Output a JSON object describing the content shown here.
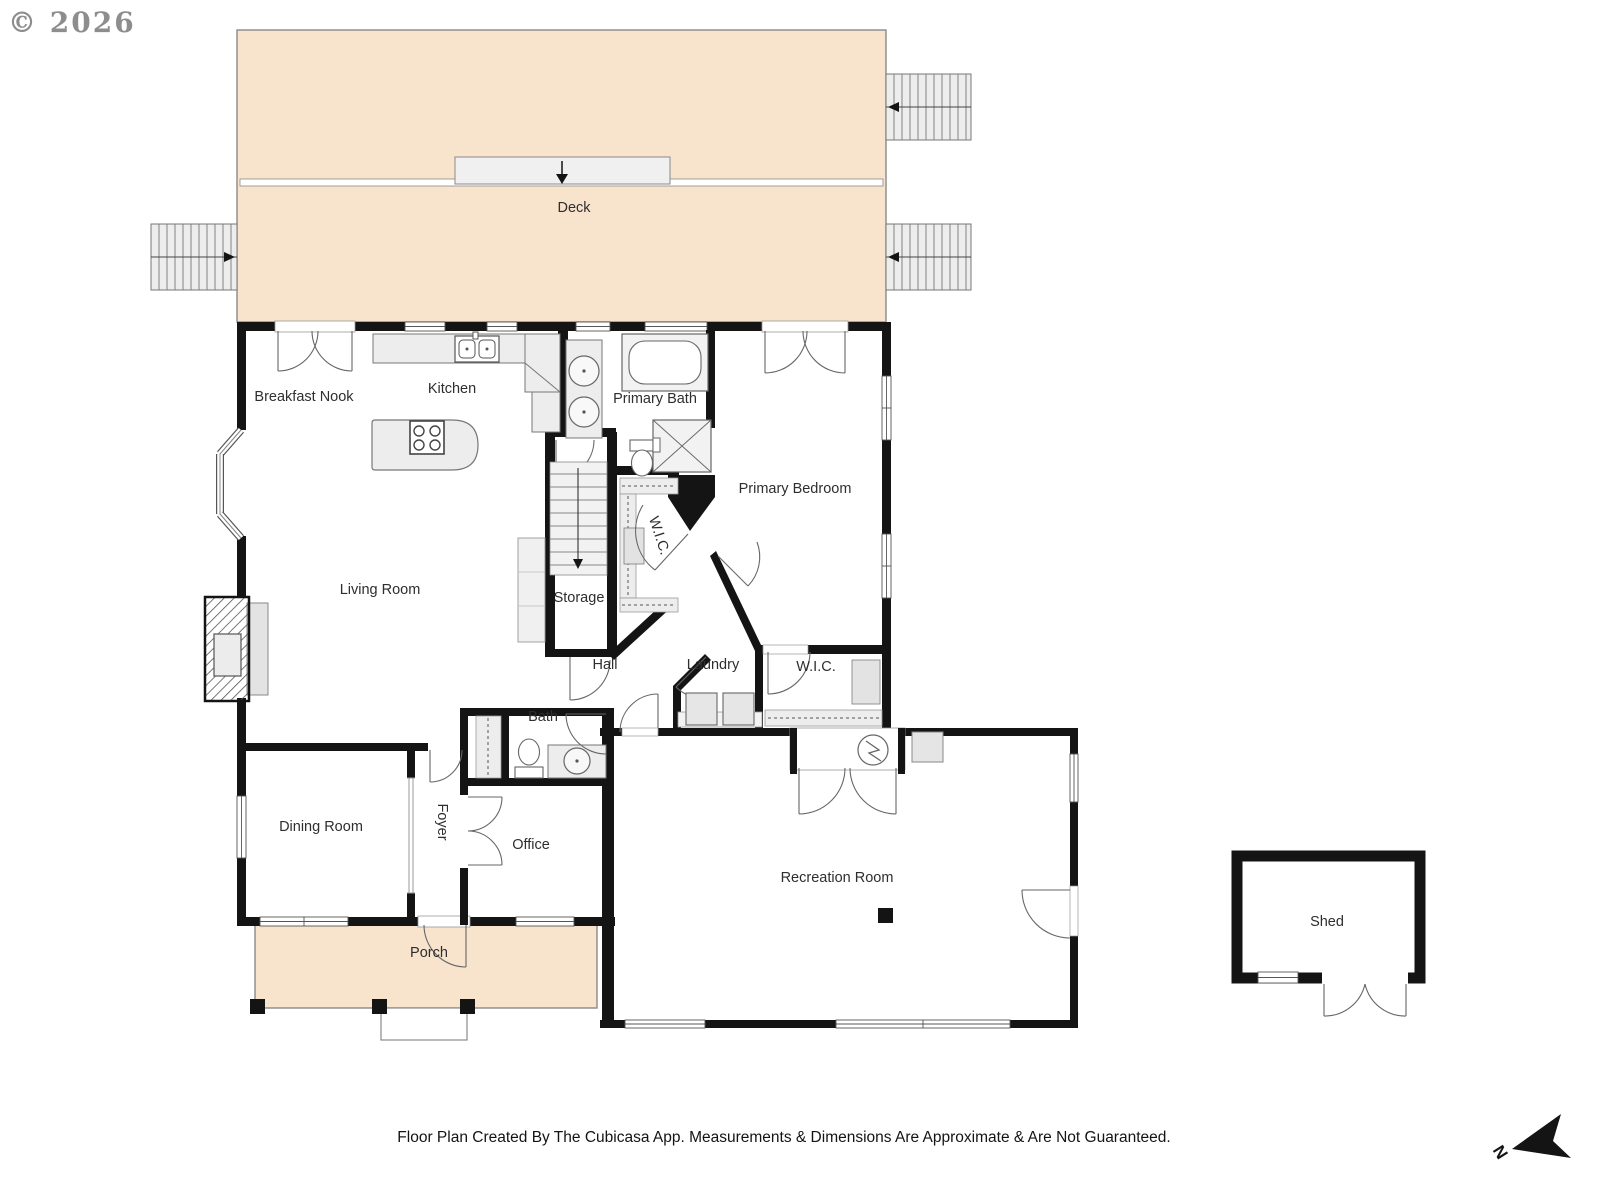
{
  "page": {
    "copyright": "© 2026",
    "footer": "Floor Plan Created By The Cubicasa App. Measurements & Dimensions Are Approximate & Are Not Guaranteed.",
    "compass": "N"
  },
  "colors": {
    "deck_fill": "#f8e3cc",
    "porch_fill": "#f8e3cc",
    "wall": "#141414",
    "fixture_fill": "#ededed",
    "fixture_stroke": "#777777",
    "label": "#2e2e2e"
  },
  "icons": [
    "stairs-icon",
    "bathtub-icon",
    "shower-icon",
    "toilet-icon",
    "sink-icon",
    "stove-icon",
    "kitchen-island",
    "washer-icon",
    "dryer-icon",
    "fireplace-icon",
    "closet-rod",
    "electrical-meter-icon",
    "north-arrow-icon",
    "door-arc",
    "window",
    "post"
  ],
  "rooms": [
    {
      "label": "Deck"
    },
    {
      "label": "Breakfast Nook"
    },
    {
      "label": "Kitchen"
    },
    {
      "label": "Primary Bath"
    },
    {
      "label": "Primary Bedroom"
    },
    {
      "label": "Living Room"
    },
    {
      "label": "W.I.C."
    },
    {
      "label": "Storage"
    },
    {
      "label": "Hall"
    },
    {
      "label": "Laundry"
    },
    {
      "label": "W.I.C."
    },
    {
      "label": "Bath"
    },
    {
      "label": "Dining Room"
    },
    {
      "label": "Foyer"
    },
    {
      "label": "Office"
    },
    {
      "label": "Recreation Room"
    },
    {
      "label": "Porch"
    },
    {
      "label": "Shed"
    }
  ]
}
